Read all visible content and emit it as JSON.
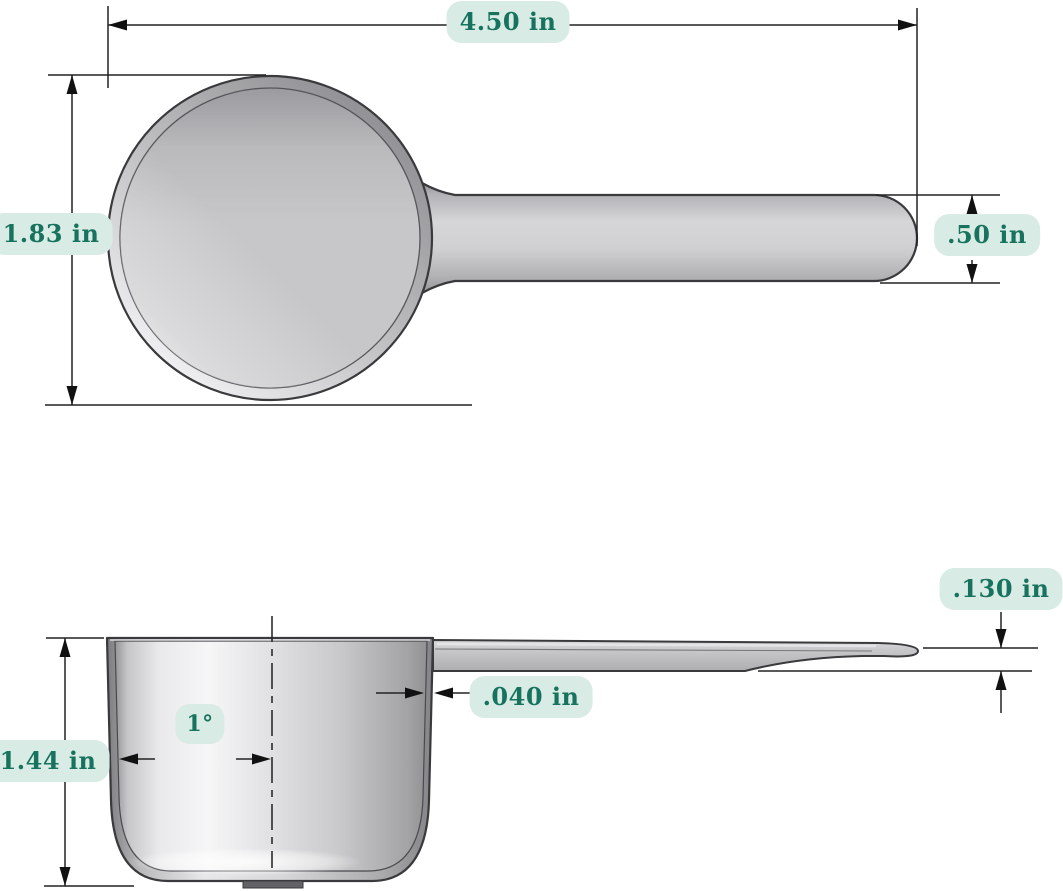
{
  "drawing": {
    "colors": {
      "label_bg": "#d8ebe4",
      "label_text": "#17735e",
      "part_gray": "#c6c6c8",
      "outline": "#3a3a3d",
      "dim_line": "#222222"
    },
    "views": {
      "top_view": {
        "dimensions": {
          "overall_length": "4.50 in",
          "bowl_diameter": "1.83 in",
          "handle_width": ".50 in"
        }
      },
      "side_view": {
        "dimensions": {
          "handle_thickness": ".130 in",
          "wall_thickness": ".040 in",
          "cup_height": "1.44 in",
          "draft_angle": "1°"
        }
      }
    }
  }
}
